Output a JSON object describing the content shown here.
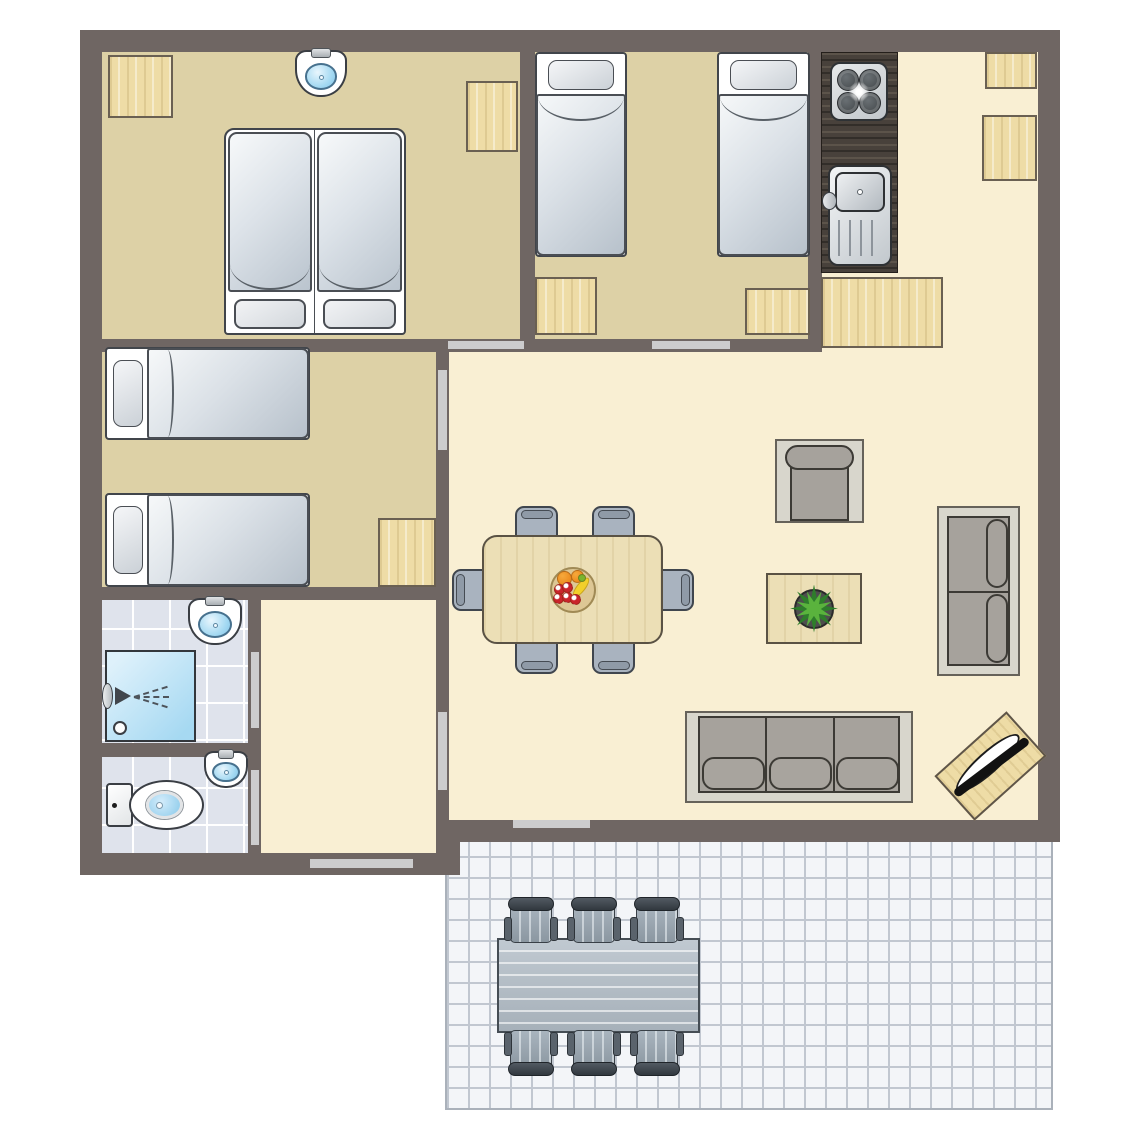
{
  "canvas": {
    "width": 1145,
    "height": 1145,
    "background": "#ffffff"
  },
  "palette": {
    "wall": "#6f6663",
    "door": "#cccccd",
    "tan": "#ddd1a6",
    "cream": "#f9efd3",
    "tile": "#dfe3ec",
    "tileline": "#ffffff",
    "terr": "#f3f5f8",
    "terrline": "#c1c7d0",
    "wood": "#eedca6",
    "counter": "#48413b",
    "chair": "#a9b3bf",
    "twood": "#ecdfb6",
    "sofa": "#a6a29c",
    "sofabase": "#d8d6cc"
  },
  "floors": [
    {
      "name": "terrace",
      "kind": "terrace",
      "x": 445,
      "y": 833,
      "w": 608,
      "h": 277
    },
    {
      "name": "master-bedroom",
      "kind": "tan",
      "x": 102,
      "y": 52,
      "w": 418,
      "h": 287
    },
    {
      "name": "twin-bedroom",
      "kind": "tan",
      "x": 535,
      "y": 52,
      "w": 273,
      "h": 287
    },
    {
      "name": "second-twin-bedroom",
      "kind": "tan",
      "x": 102,
      "y": 352,
      "w": 334,
      "h": 235
    },
    {
      "name": "kitchen",
      "kind": "cream",
      "x": 822,
      "y": 52,
      "w": 216,
      "h": 300
    },
    {
      "name": "living-room",
      "kind": "cream",
      "x": 449,
      "y": 352,
      "w": 589,
      "h": 468
    },
    {
      "name": "hallway",
      "kind": "cream",
      "x": 261,
      "y": 598,
      "w": 175,
      "h": 255
    },
    {
      "name": "bathroom",
      "kind": "tile",
      "x": 102,
      "y": 598,
      "w": 146,
      "h": 145
    },
    {
      "name": "toilet-room",
      "kind": "tile",
      "x": 102,
      "y": 757,
      "w": 146,
      "h": 96
    }
  ],
  "walls": [
    {
      "x": 80,
      "y": 30,
      "w": 980,
      "h": 22
    },
    {
      "x": 80,
      "y": 30,
      "w": 22,
      "h": 845
    },
    {
      "x": 1038,
      "y": 30,
      "w": 22,
      "h": 812
    },
    {
      "x": 436,
      "y": 820,
      "w": 624,
      "h": 22
    },
    {
      "x": 80,
      "y": 853,
      "w": 380,
      "h": 22
    },
    {
      "x": 436,
      "y": 820,
      "w": 24,
      "h": 55
    },
    {
      "x": 520,
      "y": 52,
      "w": 15,
      "h": 300
    },
    {
      "x": 808,
      "y": 52,
      "w": 14,
      "h": 300
    },
    {
      "x": 102,
      "y": 339,
      "w": 719,
      "h": 13
    },
    {
      "x": 436,
      "y": 339,
      "w": 13,
      "h": 481
    },
    {
      "x": 248,
      "y": 598,
      "w": 13,
      "h": 255
    },
    {
      "x": 102,
      "y": 587,
      "w": 346,
      "h": 13
    },
    {
      "x": 102,
      "y": 743,
      "w": 146,
      "h": 14
    }
  ],
  "doors": [
    {
      "name": "master-bedroom-door",
      "x": 448,
      "y": 341,
      "w": 76,
      "h": 8
    },
    {
      "name": "twin-bedroom-door",
      "x": 652,
      "y": 341,
      "w": 78,
      "h": 8
    },
    {
      "name": "second-twin-bedroom-door",
      "x": 438,
      "y": 370,
      "w": 9,
      "h": 80
    },
    {
      "name": "bathroom-door",
      "x": 251,
      "y": 652,
      "w": 8,
      "h": 76
    },
    {
      "name": "toilet-door",
      "x": 251,
      "y": 770,
      "w": 8,
      "h": 75
    },
    {
      "name": "hallway-living-door",
      "x": 438,
      "y": 712,
      "w": 9,
      "h": 78
    },
    {
      "name": "entrance-door",
      "x": 310,
      "y": 859,
      "w": 103,
      "h": 9
    },
    {
      "name": "terrace-door",
      "x": 513,
      "y": 820,
      "w": 77,
      "h": 8
    }
  ],
  "furniture": [
    {
      "type": "cabinet",
      "name": "wardrobe",
      "x": 108,
      "y": 55,
      "w": 65,
      "h": 63
    },
    {
      "type": "sink",
      "name": "bedroom-washbasin",
      "x": 295,
      "y": 50,
      "w": 52,
      "h": 47
    },
    {
      "type": "cabinet",
      "name": "wardrobe",
      "x": 466,
      "y": 81,
      "w": 52,
      "h": 71
    },
    {
      "type": "double-bed",
      "name": "double-bed",
      "x": 224,
      "y": 128,
      "w": 182,
      "h": 207
    },
    {
      "type": "bed-n",
      "name": "single-bed",
      "x": 535,
      "y": 52,
      "w": 92,
      "h": 205
    },
    {
      "type": "bed-n",
      "name": "single-bed",
      "x": 717,
      "y": 52,
      "w": 93,
      "h": 205
    },
    {
      "type": "cabinet",
      "name": "cabinet",
      "x": 535,
      "y": 277,
      "w": 62,
      "h": 58
    },
    {
      "type": "cabinet",
      "name": "cabinet",
      "x": 745,
      "y": 288,
      "w": 65,
      "h": 47
    },
    {
      "type": "counter",
      "name": "kitchen-counter",
      "x": 821,
      "y": 52,
      "w": 77,
      "h": 221
    },
    {
      "type": "stove",
      "name": "stove",
      "x": 830,
      "y": 62,
      "w": 58,
      "h": 59
    },
    {
      "type": "ksink",
      "name": "kitchen-sink",
      "x": 828,
      "y": 165,
      "w": 64,
      "h": 101
    },
    {
      "type": "cabinet",
      "name": "kitchen-cabinet",
      "x": 821,
      "y": 277,
      "w": 122,
      "h": 71
    },
    {
      "type": "cabinet",
      "name": "kitchen-cabinet",
      "x": 985,
      "y": 52,
      "w": 52,
      "h": 37
    },
    {
      "type": "cabinet",
      "name": "kitchen-cabinet",
      "x": 982,
      "y": 115,
      "w": 55,
      "h": 66
    },
    {
      "type": "bed-w",
      "name": "single-bed",
      "x": 105,
      "y": 347,
      "w": 205,
      "h": 93
    },
    {
      "type": "bed-w",
      "name": "single-bed",
      "x": 105,
      "y": 493,
      "w": 205,
      "h": 94
    },
    {
      "type": "cabinet",
      "name": "cabinet",
      "x": 378,
      "y": 518,
      "w": 58,
      "h": 69
    },
    {
      "type": "sink",
      "name": "bathroom-sink",
      "x": 188,
      "y": 598,
      "w": 54,
      "h": 47
    },
    {
      "type": "shower",
      "name": "shower",
      "x": 105,
      "y": 650,
      "w": 91,
      "h": 92
    },
    {
      "type": "sink",
      "name": "toilet-sink",
      "x": 204,
      "y": 751,
      "w": 44,
      "h": 37
    },
    {
      "type": "toilet",
      "name": "toilet",
      "x": 106,
      "y": 780,
      "w": 98,
      "h": 50
    },
    {
      "type": "chair",
      "dir": "n",
      "name": "dining-chair",
      "x": 515,
      "y": 506,
      "w": 43,
      "h": 42
    },
    {
      "type": "chair",
      "dir": "n",
      "name": "dining-chair",
      "x": 592,
      "y": 506,
      "w": 43,
      "h": 42
    },
    {
      "type": "chair",
      "dir": "w",
      "name": "dining-chair",
      "x": 452,
      "y": 569,
      "w": 42,
      "h": 42
    },
    {
      "type": "chair",
      "dir": "e",
      "name": "dining-chair",
      "x": 652,
      "y": 569,
      "w": 42,
      "h": 42
    },
    {
      "type": "chair",
      "dir": "s",
      "name": "dining-chair",
      "x": 515,
      "y": 632,
      "w": 43,
      "h": 42
    },
    {
      "type": "chair",
      "dir": "s",
      "name": "dining-chair",
      "x": 592,
      "y": 632,
      "w": 43,
      "h": 42
    },
    {
      "type": "dtable",
      "name": "dining-table",
      "x": 482,
      "y": 535,
      "w": 181,
      "h": 109
    },
    {
      "type": "armchair",
      "name": "armchair",
      "x": 775,
      "y": 439,
      "w": 89,
      "h": 84
    },
    {
      "type": "ctable",
      "name": "coffee-table",
      "x": 766,
      "y": 573,
      "w": 96,
      "h": 71
    },
    {
      "type": "sofa2",
      "name": "sofa-2-seat",
      "x": 937,
      "y": 506,
      "w": 83,
      "h": 170
    },
    {
      "type": "sofa3",
      "name": "sofa-3-seat",
      "x": 685,
      "y": 711,
      "w": 228,
      "h": 92
    },
    {
      "type": "tv",
      "name": "tv-unit",
      "x": 942,
      "y": 736,
      "w": 97,
      "h": 60,
      "rot": -42
    },
    {
      "type": "otable",
      "name": "terrace-table",
      "x": 497,
      "y": 938,
      "w": 203,
      "h": 95
    },
    {
      "type": "ochair",
      "dir": "n",
      "name": "terrace-chair",
      "x": 505,
      "y": 897,
      "w": 52,
      "h": 46
    },
    {
      "type": "ochair",
      "dir": "n",
      "name": "terrace-chair",
      "x": 568,
      "y": 897,
      "w": 52,
      "h": 46
    },
    {
      "type": "ochair",
      "dir": "n",
      "name": "terrace-chair",
      "x": 631,
      "y": 897,
      "w": 52,
      "h": 46
    },
    {
      "type": "ochair",
      "dir": "s",
      "name": "terrace-chair",
      "x": 505,
      "y": 1030,
      "w": 52,
      "h": 46
    },
    {
      "type": "ochair",
      "dir": "s",
      "name": "terrace-chair",
      "x": 568,
      "y": 1030,
      "w": 52,
      "h": 46
    },
    {
      "type": "ochair",
      "dir": "s",
      "name": "terrace-chair",
      "x": 631,
      "y": 1030,
      "w": 52,
      "h": 46
    }
  ]
}
